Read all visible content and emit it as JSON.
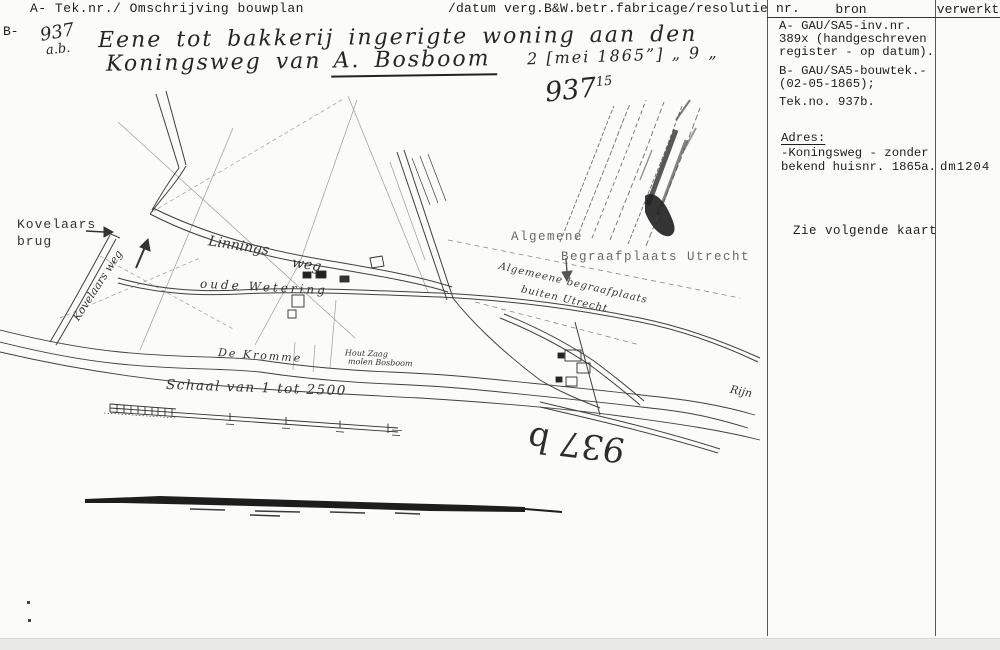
{
  "header": {
    "left_label": "A- Tek.nr./ Omschrijving bouwplan",
    "right_label": "/datum verg.B&W.betr.fabricage/resolutie nr.",
    "row_label_b": "B-"
  },
  "handwritten": {
    "tek_nr": "937",
    "tek_nr_suffix": "a.b.",
    "description_line1": "Eene tot bakkerij ingerigte woning aan den",
    "description_line2_prefix": "Koningsweg van",
    "description_name": "A. Bosboom",
    "date_note": "2 [mei 1865”]  „ 9 „",
    "number_note": "937",
    "number_note_sup": "15",
    "plan_number_reversed": "937 b"
  },
  "source_table": {
    "col_bron": "bron",
    "col_verwerkt": "verwerkt",
    "bron_lines": {
      "0": "A- GAU/SA5-inv.nr.",
      "1": "389x (handgeschreven",
      "2": "register - op datum).",
      "3": "B- GAU/SA5-bouwtek.-",
      "4": "(02-05-1865);",
      "5": "Tek.no. 937b."
    },
    "adres_heading": "Adres:",
    "adres_line1": "-Koningsweg - zonder",
    "adres_line2": "bekend huisnr. 1865a.",
    "adres_overflow": "dm1204",
    "note": "Zie volgende kaart"
  },
  "map": {
    "typed_labels": {
      "kovelaars_line1": "Kovelaars",
      "kovelaars_line2": "brug",
      "algemene": "Algemene",
      "begraafplaats": "Begraafplaats Utrecht"
    },
    "handwritten_labels": {
      "kovelaarsweg": "Kovelaars weg",
      "linnings": "Linnings",
      "weg": "weg",
      "wetering": "oude Wetering",
      "kromme": "De Kromme",
      "rijn": "Rijn",
      "houtzaag_line1": "Hout Zaag",
      "houtzaag_line2": "molen Bosboom",
      "cemetery_line1": "Algemeene begraafplaats",
      "cemetery_line2": "buiten Utrecht",
      "schaal": "Schaal van 1 tot 2500"
    }
  }
}
